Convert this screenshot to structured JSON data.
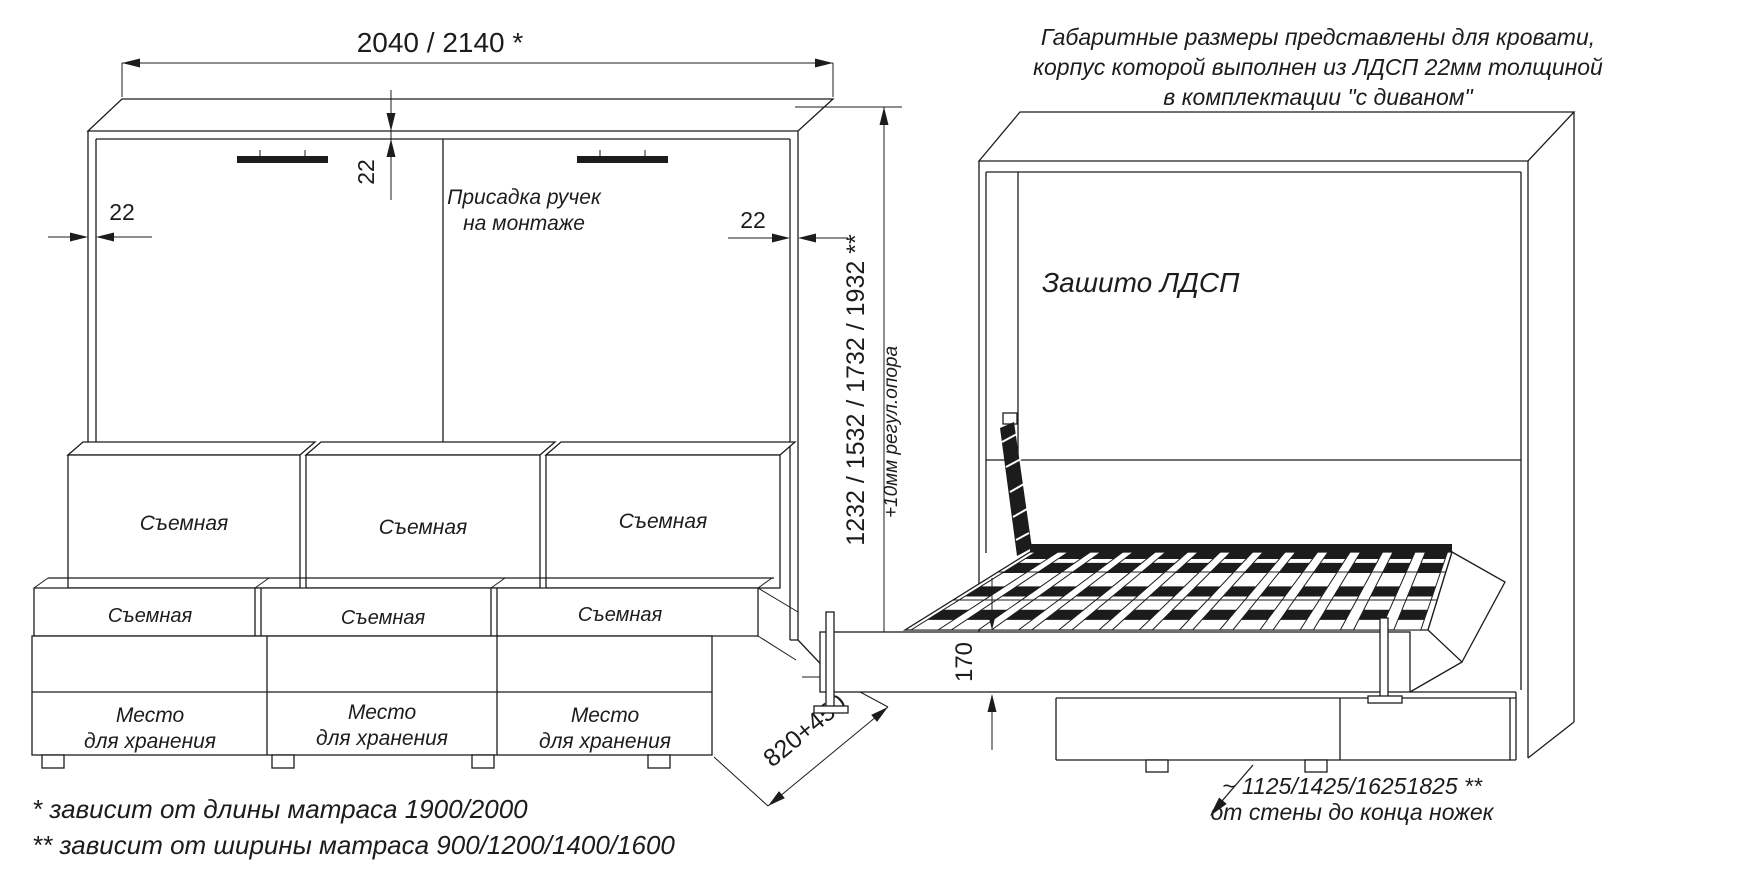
{
  "drawing_title": "Схема кровати-трансформера с диваном",
  "right_view": {
    "note_line1": "Габаритные размеры представлены для кровати,",
    "note_line2": "корпус которой выполнен из ЛДСП 22мм толщиной",
    "note_line3": "в комплектации \"с диваном\"",
    "panel_label": "Зашито ЛДСП",
    "rail_height_dim": "170",
    "legs_distance_line1": "~ 1125/1425/16251825 **",
    "legs_distance_line2": "от стены до конца ножек"
  },
  "left_view": {
    "width_dim": "2040 / 2140 *",
    "thickness_dim": "22",
    "handle_note_line1": "Присадка ручек",
    "handle_note_line2": "на монтаже",
    "height_dim": "1232 / 1532 / 1732 / 1932 **",
    "height_adjust_note": "+10мм регул.опора",
    "depth_dim": "820+450",
    "cushion_label": "Съемная",
    "storage_label_line1": "Место",
    "storage_label_line2": "для хранения",
    "footnote1": "*  зависит от длины матраса 1900/2000",
    "footnote2": "** зависит от ширины матраса 900/1200/1400/1600"
  },
  "colors": {
    "line": "#1c1c1c",
    "background": "#ffffff"
  }
}
